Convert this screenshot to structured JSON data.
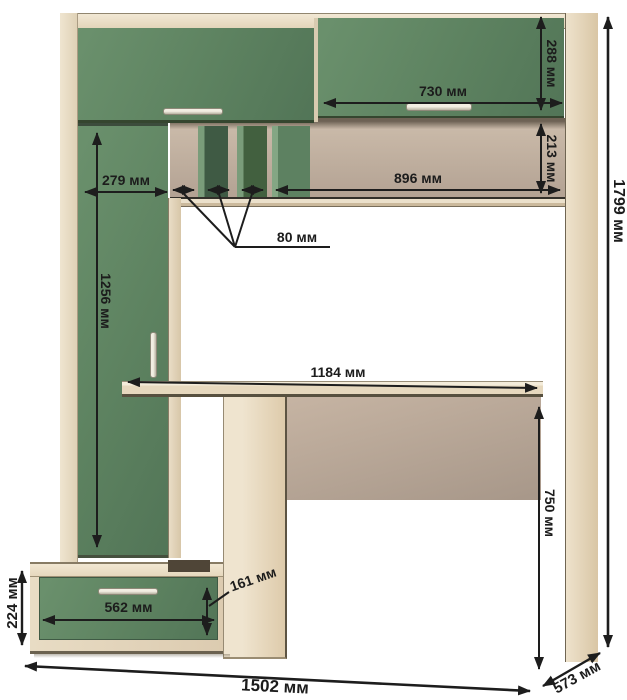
{
  "diagram": {
    "unit": "мм",
    "dimensions": {
      "top_door_height": "288 мм",
      "top_right_door_width": "730 мм",
      "niche_height": "213 мм",
      "niche_width": "896 мм",
      "left_section_width": "279 мм",
      "slot_width": "80 мм",
      "left_door_height": "1256 мм",
      "desktop_width": "1184 мм",
      "desk_height": "750 мм",
      "overall_height": "1799 мм",
      "drawer_unit_height": "224 мм",
      "drawer_width": "562 мм",
      "drawer_front_height": "161 мм",
      "overall_width": "1502 мм",
      "depth": "573 мм"
    },
    "colors": {
      "facade_green": "#5d8260",
      "carcass_beige": "#eadec7",
      "niche_taupe": "#b7a697",
      "dimension_line": "#1d1d1d",
      "background": "#ffffff"
    }
  }
}
